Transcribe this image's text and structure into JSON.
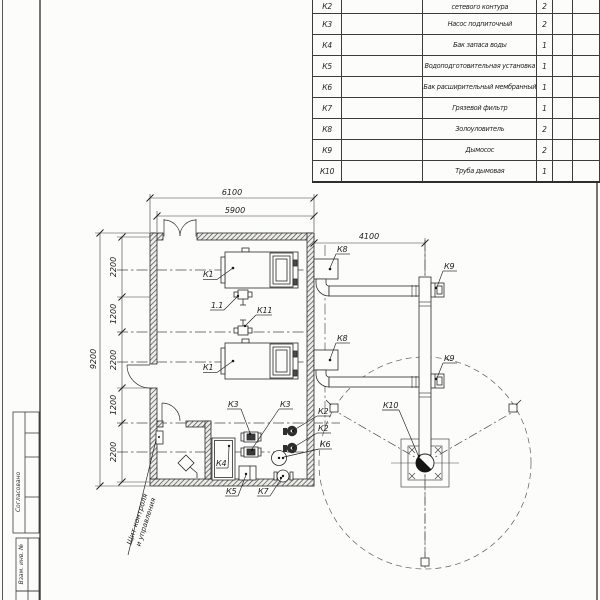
{
  "stamp": {
    "agreed": "Согласовано",
    "vzam": "Взам. инв. №"
  },
  "spec_table": {
    "rows": [
      {
        "pos": "К2",
        "name": "сетевого контура",
        "qty": "2"
      },
      {
        "pos": "К3",
        "name": "Насос подпиточный",
        "qty": "2"
      },
      {
        "pos": "К4",
        "name": "Бак запаса воды",
        "qty": "1"
      },
      {
        "pos": "К5",
        "name": "Водоподготовительная установка",
        "qty": "1"
      },
      {
        "pos": "К6",
        "name": "Бак расширительный мембранный",
        "qty": "1"
      },
      {
        "pos": "К7",
        "name": "Грязевой фильтр",
        "qty": "1"
      },
      {
        "pos": "К8",
        "name": "Золоуловитель",
        "qty": "2"
      },
      {
        "pos": "К9",
        "name": "Дымосос",
        "qty": "2"
      },
      {
        "pos": "К10",
        "name": "Труба дымовая",
        "qty": "1"
      }
    ]
  },
  "dims": {
    "top_outer": "6100",
    "top_inner": "5900",
    "flue": "4100",
    "left_overall": "9200",
    "chain": [
      "2200",
      "1200",
      "2200",
      "1200",
      "2200"
    ]
  },
  "labels": {
    "k1_top": "К1",
    "k1_bottom": "К1",
    "v11": "1.1",
    "k11": "К11",
    "k3_left": "К3",
    "k3_right": "К3",
    "k2_top": "К2",
    "k2_bottom": "К2",
    "k4": "К4",
    "k5": "К5",
    "k6": "К6",
    "k7": "К7",
    "k8_top": "К8",
    "k8_bottom": "К8",
    "k9_top": "К9",
    "k9_bottom": "К9",
    "k10": "К10",
    "panel_line1": "Щит контроля",
    "panel_line2": "и управления"
  },
  "colors": {
    "line": "#2b2b2b",
    "thin": "#444444",
    "paper": "#fcfcfb"
  }
}
